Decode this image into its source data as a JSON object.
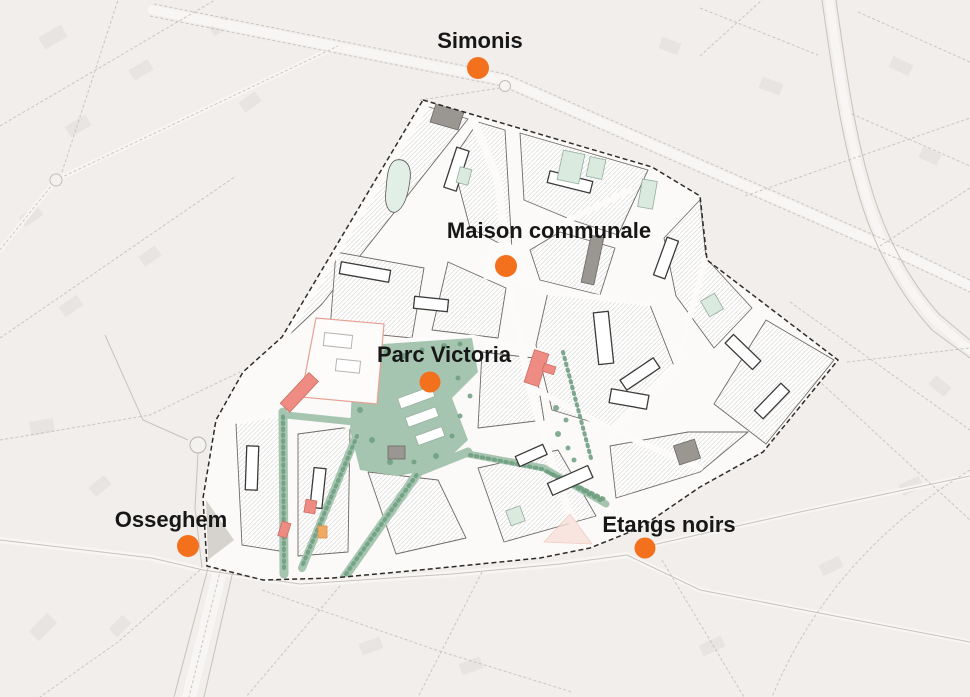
{
  "map": {
    "description": "Masterplan map of the Parc Victoria study area with metro stations",
    "area_name": "study-area"
  },
  "colors": {
    "background": "#f1eeec",
    "area_fill": "#fbfaf8",
    "boundary": "#2e2c2a",
    "park": "#a6c5b1",
    "tree": "#6f9e81",
    "water": "#e2efe6",
    "salmon_building": "#ee8c83",
    "orange_building": "#f2a964",
    "gray_building": "#9a9692",
    "mint_building": "#dbeadf",
    "station_dot": "#f3701d",
    "label_text": "#171717"
  },
  "stations": [
    {
      "id": "simonis",
      "label": "Simonis",
      "x": 478,
      "y": 68,
      "r": 11,
      "label_x": 480,
      "label_y": 48
    },
    {
      "id": "maison-communale",
      "label": "Maison communale",
      "x": 506,
      "y": 266,
      "r": 11,
      "label_x": 549,
      "label_y": 238
    },
    {
      "id": "parc-victoria",
      "label": "Parc Victoria",
      "x": 430,
      "y": 382,
      "r": 10.5,
      "label_x": 444,
      "label_y": 362
    },
    {
      "id": "osseghem",
      "label": "Osseghem",
      "x": 188,
      "y": 546,
      "r": 11,
      "label_x": 171,
      "label_y": 527
    },
    {
      "id": "etangs-noirs",
      "label": "Etangs noirs",
      "x": 645,
      "y": 548,
      "r": 10.5,
      "label_x": 669,
      "label_y": 532
    }
  ]
}
